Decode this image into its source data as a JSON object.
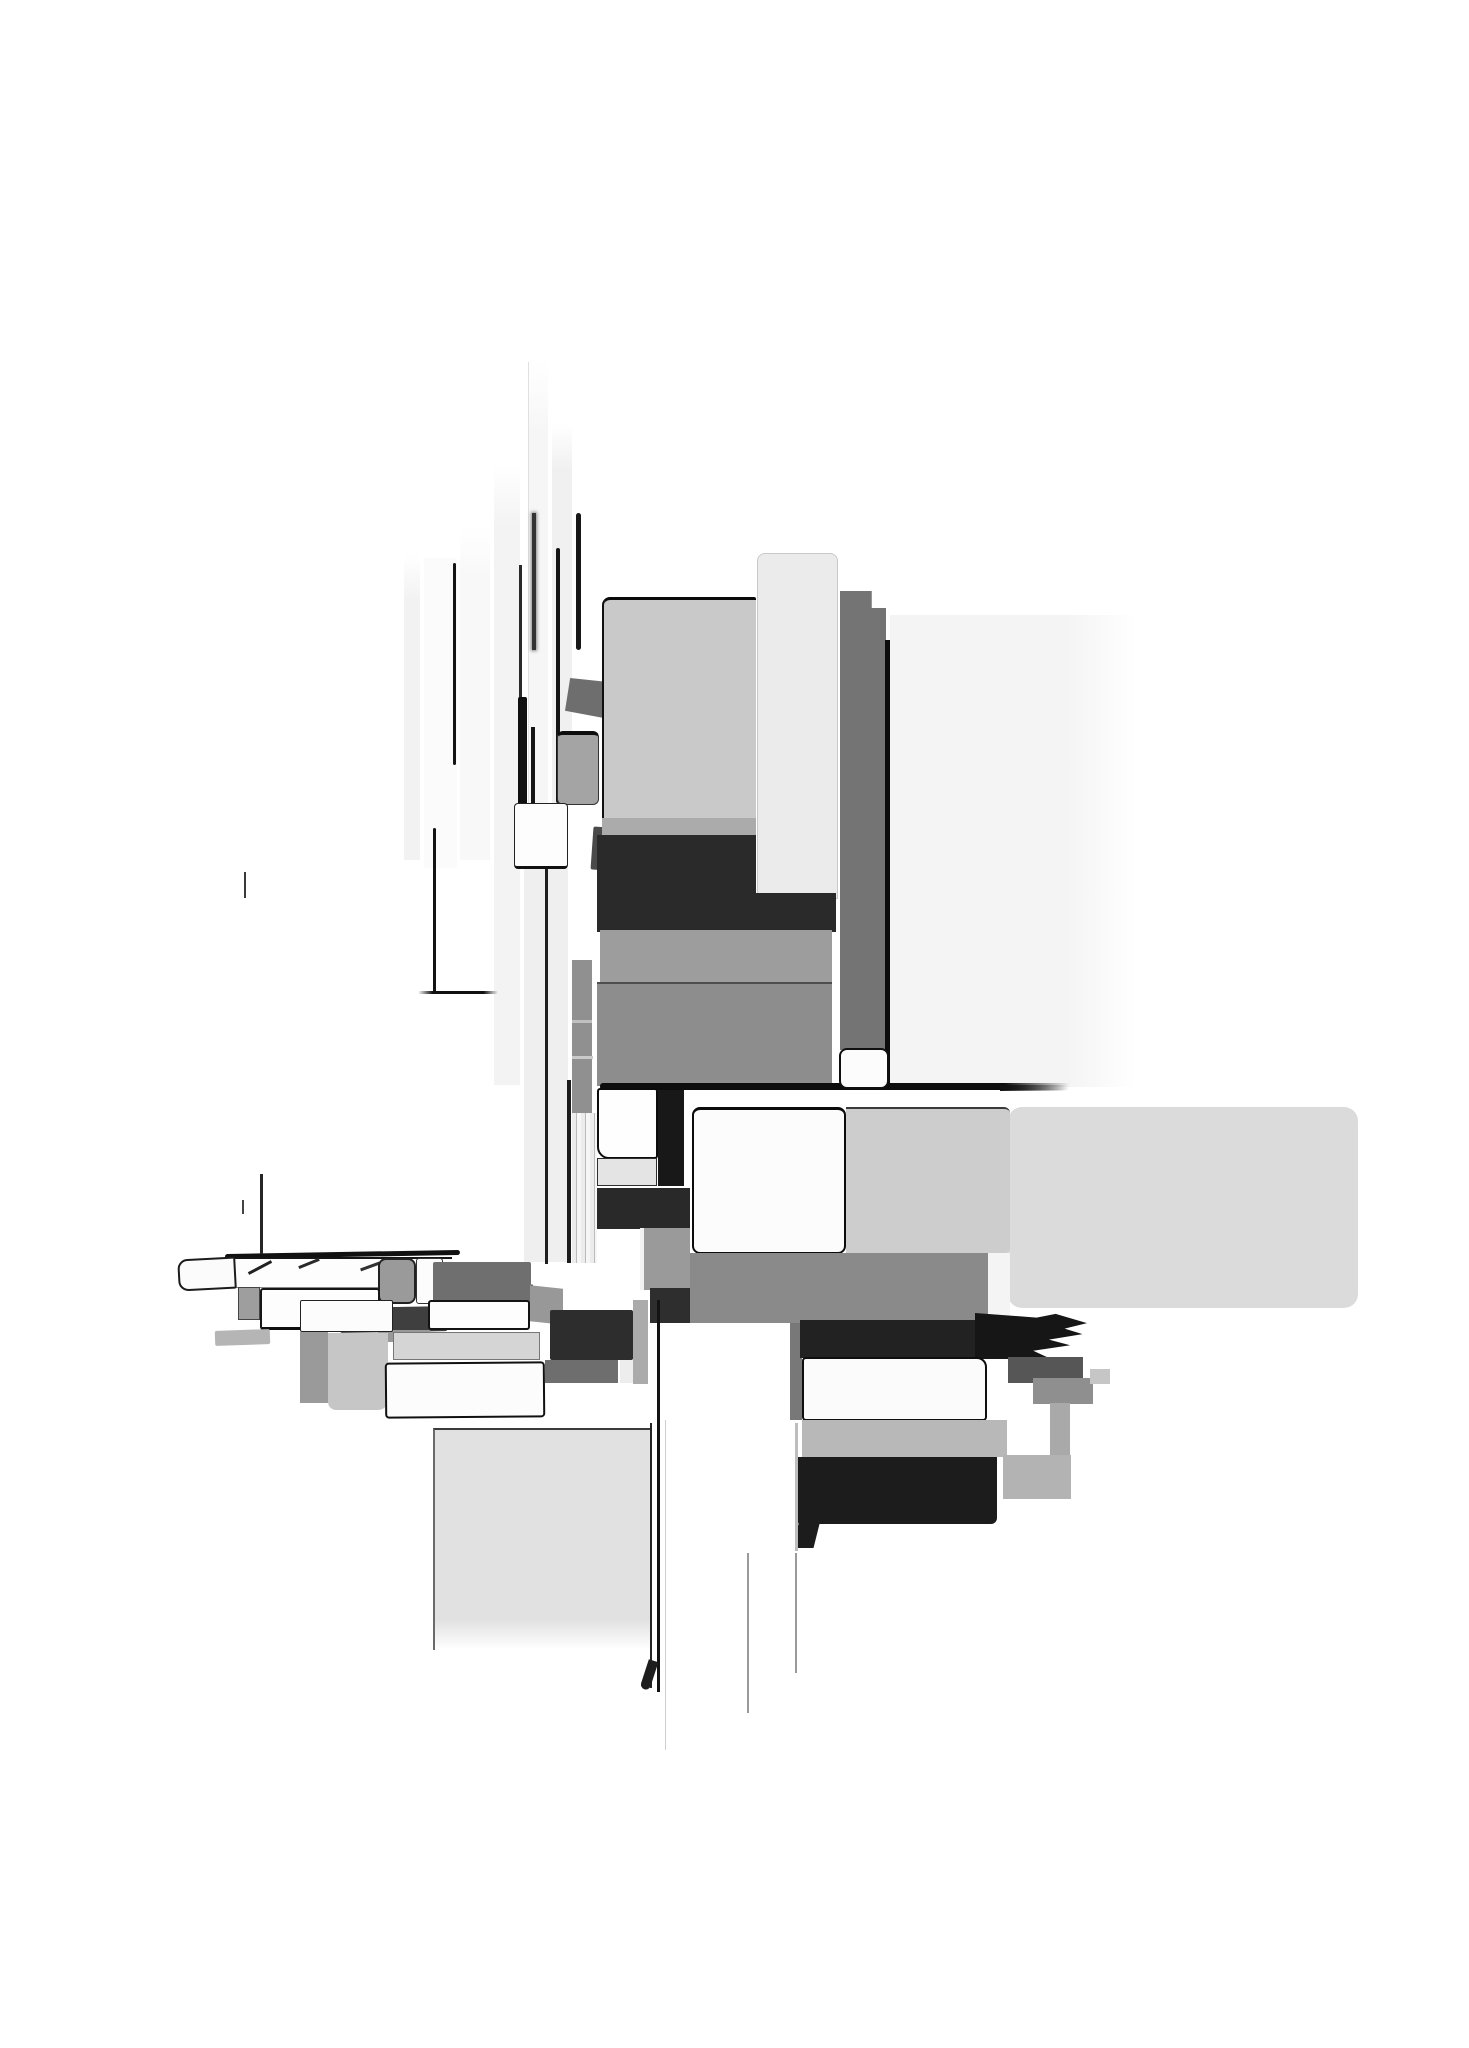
{
  "meta": {
    "title": "abstract-grayscale-block-composition",
    "background_color": "#ffffff",
    "palette": {
      "near_black": "#111111",
      "dark": "#2a2a2a",
      "mid_dark": "#6f6f6f",
      "mid": "#8d8d8d",
      "light_mid": "#9e9e9e",
      "light": "#c9c9c9",
      "pale": "#dcdcdc",
      "faint": "#f4f4f4"
    }
  },
  "shapes": [
    {
      "n": "upper-right-pale-field",
      "x": 890,
      "y": 615,
      "w": 246,
      "h": 472,
      "g": "linear-gradient(90deg,#f4f4f4 0%,#f4f4f4 72%,rgba(255,255,255,0) 100%)"
    },
    {
      "n": "faint-strip-e",
      "x": 404,
      "y": 555,
      "w": 16,
      "h": 305,
      "g": "linear-gradient(180deg,rgba(242,242,242,0),#f2f2f2 15%)"
    },
    {
      "n": "white-strip-d",
      "x": 424,
      "y": 558,
      "w": 33,
      "h": 310,
      "c": "#fbfbfb"
    },
    {
      "n": "faint-strip-c",
      "x": 460,
      "y": 527,
      "w": 30,
      "h": 333,
      "g": "linear-gradient(180deg,rgba(248,248,248,0),#f8f8f8 15%)"
    },
    {
      "n": "faint-strip-b",
      "x": 494,
      "y": 465,
      "w": 26,
      "h": 620,
      "g": "linear-gradient(180deg,rgba(243,243,243,0),#f3f3f3 10%)"
    },
    {
      "n": "tall-pale-column",
      "x": 528,
      "y": 362,
      "w": 20,
      "h": 900,
      "g": "linear-gradient(180deg,rgba(246,246,246,0),#f6f6f6 8%)",
      "bl": "1px solid #e0e0e0"
    },
    {
      "n": "faint-strip-f",
      "x": 552,
      "y": 425,
      "w": 20,
      "h": 378,
      "g": "linear-gradient(180deg,rgba(240,240,240,0),#f0f0f0 12%)"
    },
    {
      "n": "pale-column-lower",
      "x": 524,
      "y": 868,
      "w": 44,
      "h": 394,
      "c": "#efefef"
    },
    {
      "n": "small-gray-column",
      "x": 572,
      "y": 960,
      "w": 20,
      "h": 153,
      "c": "#909090"
    },
    {
      "n": "gray-column-divider-1",
      "x": 572,
      "y": 1020,
      "w": 20,
      "h": 3,
      "c": "#c0c0c0"
    },
    {
      "n": "gray-column-divider-2",
      "x": 572,
      "y": 1056,
      "w": 21,
      "h": 3,
      "c": "#c9c9c9"
    },
    {
      "n": "striped-strip",
      "x": 572,
      "y": 1113,
      "w": 25,
      "h": 150,
      "g": "repeating-linear-gradient(90deg,#ececec 0 4px,#bbbbbb 4px 5px,#f6f6f6 5px 9px)"
    },
    {
      "n": "strip-d-right-edge",
      "x": 453,
      "y": 563,
      "w": 3,
      "h": 202,
      "c": "#161616",
      "r": "2px"
    },
    {
      "n": "thin-line-pair",
      "x": 519,
      "y": 565,
      "w": 3,
      "h": 140,
      "c": "#2a2a2a"
    },
    {
      "n": "thick-black-bar",
      "x": 518,
      "y": 697,
      "w": 9,
      "h": 108,
      "c": "#101010",
      "r": "2px"
    },
    {
      "n": "inner-black-line",
      "x": 531,
      "y": 727,
      "w": 4,
      "h": 76,
      "c": "#151515"
    },
    {
      "n": "blurred-black-line",
      "x": 532,
      "y": 513,
      "w": 4,
      "h": 137,
      "c": "#333333",
      "sh": "0 0 3px 1px rgba(40,40,40,0.55)"
    },
    {
      "n": "strip-f-left-edge",
      "x": 556,
      "y": 548,
      "w": 4,
      "h": 255,
      "c": "#141414",
      "r": "2px"
    },
    {
      "n": "strip-f-right-edge",
      "x": 576,
      "y": 513,
      "w": 5,
      "h": 137,
      "c": "#181818",
      "r": "3px"
    },
    {
      "n": "column-hairline",
      "x": 545,
      "y": 866,
      "w": 3,
      "h": 398,
      "c": "#1f1f1f"
    },
    {
      "n": "column-right-edge",
      "x": 567,
      "y": 1080,
      "w": 4,
      "h": 183,
      "c": "#1c1c1c"
    },
    {
      "n": "skewed-dark-wedge",
      "x": 565,
      "y": 678,
      "w": 43,
      "h": 40,
      "c": "#6e6e6e",
      "cp": "polygon(12% 0,100% 10%,90% 100%,0 82%)"
    },
    {
      "n": "mid-gray-block",
      "x": 557,
      "y": 731,
      "w": 42,
      "h": 74,
      "c": "#a4a4a4",
      "b": "1px solid #333333",
      "bt": "4px solid #0d0d0d",
      "r": "6px"
    },
    {
      "n": "small-white-block",
      "x": 514,
      "y": 803,
      "w": 54,
      "h": 66,
      "c": "#fdfdfd",
      "b": "1px solid #222222",
      "bb": "3px solid #111111",
      "r": "4px"
    },
    {
      "n": "small-dark-wedge",
      "x": 592,
      "y": 827,
      "w": 17,
      "h": 43,
      "c": "#4a4a4a",
      "t": "rotate(4deg)",
      "r": "2px"
    },
    {
      "n": "tower-main-slab",
      "x": 602,
      "y": 597,
      "w": 154,
      "h": 240,
      "c": "#c9c9c9",
      "bt": "3px solid #090909",
      "bl": "2px solid #101010",
      "bb": "3px solid #090909",
      "r": "8px 2px 0 0"
    },
    {
      "n": "tower-bottom-sliver",
      "x": 602,
      "y": 818,
      "w": 154,
      "h": 17,
      "c": "#ababab"
    },
    {
      "n": "tower-pale-slab",
      "x": 757,
      "y": 553,
      "w": 81,
      "h": 346,
      "c": "#ebebeb",
      "b": "1px solid #c9c9c9",
      "r": "8px 8px 0 0"
    },
    {
      "n": "tower-darkgray-strip",
      "x": 840,
      "y": 591,
      "w": 46,
      "h": 459,
      "c": "#747474",
      "cp": "polygon(0 0,69% 0,69% 3.7%,100% 3.7%,100% 100%,0 100%)"
    },
    {
      "n": "tower-black-strip",
      "x": 885,
      "y": 640,
      "w": 5,
      "h": 447,
      "c": "#0c0c0c"
    },
    {
      "n": "central-dark-block",
      "x": 597,
      "y": 835,
      "w": 159,
      "h": 97,
      "c": "#2a2a2a"
    },
    {
      "n": "central-dark-block-ext",
      "x": 754,
      "y": 893,
      "w": 82,
      "h": 39,
      "c": "#2a2a2a"
    },
    {
      "n": "gray-band-upper",
      "x": 600,
      "y": 930,
      "w": 232,
      "h": 53,
      "c": "#9d9d9d"
    },
    {
      "n": "gray-band-lower",
      "x": 597,
      "y": 982,
      "w": 235,
      "h": 104,
      "c": "#8d8d8d",
      "bt": "2px solid #4e4e4e"
    },
    {
      "n": "main-horizontal-line",
      "x": 600,
      "y": 1083,
      "w": 470,
      "h": 7,
      "g": "linear-gradient(90deg,#0d0d0d 0%,#0d0d0d 86%,rgba(13,13,13,0) 100%)",
      "r": "3px"
    },
    {
      "n": "strip-foot-white-block",
      "x": 839,
      "y": 1048,
      "w": 50,
      "h": 41,
      "c": "#fcfcfc",
      "b": "2px solid #101010",
      "r": "8px"
    },
    {
      "n": "center-white-block",
      "x": 597,
      "y": 1088,
      "w": 61,
      "h": 71,
      "c": "#fefefe",
      "b": "2px solid #0c0c0c",
      "r": "3px 3px 3px 12px"
    },
    {
      "n": "center-black-strip",
      "x": 658,
      "y": 1090,
      "w": 26,
      "h": 96,
      "c": "#181818"
    },
    {
      "n": "center-pale-band",
      "x": 597,
      "y": 1158,
      "w": 60,
      "h": 28,
      "c": "#e4e4e4",
      "b": "1px solid #2e2e2e"
    },
    {
      "n": "center-dark-band",
      "x": 597,
      "y": 1188,
      "w": 93,
      "h": 41,
      "c": "#292929"
    },
    {
      "n": "center-gray-piece",
      "x": 640,
      "y": 1228,
      "w": 50,
      "h": 62,
      "c": "#9a9a9a",
      "bl": "4px solid #f2f2f2"
    },
    {
      "n": "center-dark-piece",
      "x": 650,
      "y": 1288,
      "w": 40,
      "h": 35,
      "c": "#2e2e2e"
    },
    {
      "n": "center-white-sliver",
      "x": 620,
      "y": 1318,
      "w": 13,
      "h": 65,
      "c": "#ededed"
    },
    {
      "n": "center-gray-sliver",
      "x": 633,
      "y": 1300,
      "w": 15,
      "h": 84,
      "c": "#ababab"
    },
    {
      "n": "right-arm-pale-slab",
      "x": 1008,
      "y": 1107,
      "w": 350,
      "h": 201,
      "c": "#dbdbdb",
      "r": "14px"
    },
    {
      "n": "right-arm-gray-slab",
      "x": 846,
      "y": 1107,
      "w": 164,
      "h": 147,
      "c": "#cdcdcd",
      "bt": "2px solid #3a3a3a",
      "r": "0 6px 6px 0"
    },
    {
      "n": "right-arm-white-slab",
      "x": 692,
      "y": 1107,
      "w": 154,
      "h": 147,
      "c": "#fcfcfc",
      "b": "2px solid #0b0b0b",
      "bt": "3px solid #0b0b0b",
      "r": "8px"
    },
    {
      "n": "fading-line-right",
      "x": 1000,
      "y": 1085,
      "w": 67,
      "h": 6,
      "g": "linear-gradient(90deg,#111111,rgba(17,17,17,0))"
    },
    {
      "n": "arm-mid-gray-band",
      "x": 690,
      "y": 1253,
      "w": 298,
      "h": 70,
      "c": "#8a8a8a"
    },
    {
      "n": "arm-white-strip",
      "x": 988,
      "y": 1253,
      "w": 22,
      "h": 70,
      "c": "#f4f4f4"
    },
    {
      "n": "arm-left-gray-strip",
      "x": 790,
      "y": 1323,
      "w": 12,
      "h": 97,
      "c": "#787878"
    },
    {
      "n": "arm-black-band",
      "x": 800,
      "y": 1320,
      "w": 178,
      "h": 38,
      "c": "#222222"
    },
    {
      "n": "arm-black-spiky",
      "x": 975,
      "y": 1313,
      "w": 112,
      "h": 46,
      "c": "#161616",
      "cp": "polygon(0 0,55% 10%,72% 2%,100% 22%,80% 34%,96% 46%,66% 58%,85% 70%,52% 82%,68% 100%,0 100%)"
    },
    {
      "n": "arm-darkgray-block",
      "x": 1008,
      "y": 1357,
      "w": 75,
      "h": 26,
      "c": "#565656"
    },
    {
      "n": "arm-gray-block",
      "x": 1033,
      "y": 1378,
      "w": 60,
      "h": 26,
      "c": "#8f8f8f"
    },
    {
      "n": "arm-light-piece",
      "x": 1090,
      "y": 1369,
      "w": 20,
      "h": 15,
      "c": "#c6c6c6"
    },
    {
      "n": "arm-white-band",
      "x": 802,
      "y": 1357,
      "w": 185,
      "h": 64,
      "c": "#fbfbfb",
      "b": "2px solid #0e0e0e",
      "r": "4px 10px 4px 4px"
    },
    {
      "n": "arm-lightgray-band",
      "x": 802,
      "y": 1420,
      "w": 205,
      "h": 37,
      "c": "#b8b8b8"
    },
    {
      "n": "bottom-black-block",
      "x": 798,
      "y": 1457,
      "w": 199,
      "h": 67,
      "c": "#1c1c1c",
      "r": "0 0 6px 2px"
    },
    {
      "n": "bottom-black-foot",
      "x": 796,
      "y": 1520,
      "w": 21,
      "h": 28,
      "c": "#1c1c1c",
      "t": "skewX(-14deg)"
    },
    {
      "n": "bottom-gray-strip",
      "x": 1050,
      "y": 1403,
      "w": 20,
      "h": 53,
      "c": "#a9a9a9"
    },
    {
      "n": "bottom-gray-patch",
      "x": 1003,
      "y": 1455,
      "w": 68,
      "h": 44,
      "c": "#b3b3b3"
    },
    {
      "n": "bottom-white-column",
      "x": 665,
      "y": 1420,
      "w": 133,
      "h": 330,
      "c": "#ffffff",
      "bl": "1px solid #cfcfcf"
    },
    {
      "n": "double-line-a",
      "x": 650,
      "y": 1423,
      "w": 2,
      "h": 265,
      "c": "#242424"
    },
    {
      "n": "double-line-b",
      "x": 657,
      "y": 1300,
      "w": 3,
      "h": 392,
      "c": "#131313"
    },
    {
      "n": "line-foot-curl",
      "x": 644,
      "y": 1660,
      "w": 10,
      "h": 30,
      "c": "#1d1d1d",
      "t": "rotate(18deg)",
      "r": "0 0 6px 6px"
    },
    {
      "n": "bottom-pale-slab",
      "x": 433,
      "y": 1428,
      "w": 217,
      "h": 222,
      "g": "linear-gradient(180deg,#e1e1e1 0%,#e1e1e1 86%,rgba(225,225,225,0) 100%)",
      "bl": "2px solid #6a6a6a",
      "bt": "2px solid #3a3a3a"
    },
    {
      "n": "thin-line-bottom-1",
      "x": 747,
      "y": 1553,
      "w": 2,
      "h": 160,
      "c": "#9a9a9a"
    },
    {
      "n": "thin-line-bottom-2",
      "x": 795,
      "y": 1553,
      "w": 2,
      "h": 120,
      "c": "#9a9a9a"
    },
    {
      "n": "column-right-hairline",
      "x": 795,
      "y": 1423,
      "w": 3,
      "h": 128,
      "c": "#bdbdbd"
    },
    {
      "n": "leftarm-top-line",
      "x": 225,
      "y": 1252,
      "w": 235,
      "h": 5,
      "c": "#111111",
      "r": "3px",
      "t": "rotate(-1deg)"
    },
    {
      "n": "leftarm-white-band",
      "x": 235,
      "y": 1257,
      "w": 217,
      "h": 31,
      "c": "#fdfdfd",
      "bt": "2px solid #151515",
      "bb": "1px solid #888888"
    },
    {
      "n": "leftarm-tip",
      "x": 178,
      "y": 1258,
      "w": 58,
      "h": 32,
      "c": "#fbfbfb",
      "b": "2px solid #1c1c1c",
      "r": "10px 2px 2px 10px",
      "t": "rotate(-3deg)"
    },
    {
      "n": "hatch-mark-1",
      "x": 247,
      "y": 1266,
      "w": 26,
      "h": 3,
      "c": "#222222",
      "t": "rotate(-28deg)"
    },
    {
      "n": "hatch-mark-2",
      "x": 298,
      "y": 1262,
      "w": 22,
      "h": 3,
      "c": "#2a2a2a",
      "t": "rotate(-22deg)"
    },
    {
      "n": "hatch-mark-3",
      "x": 360,
      "y": 1265,
      "w": 20,
      "h": 3,
      "c": "#333333",
      "t": "rotate(-20deg)"
    },
    {
      "n": "hatch-mark-4",
      "x": 445,
      "y": 1268,
      "w": 18,
      "h": 3,
      "c": "#222222",
      "t": "rotate(-26deg)"
    },
    {
      "n": "hatch-mark-5",
      "x": 518,
      "y": 1288,
      "w": 16,
      "h": 3,
      "c": "#222222",
      "t": "rotate(-30deg)"
    },
    {
      "n": "hatch-mark-6",
      "x": 332,
      "y": 1303,
      "w": 18,
      "h": 3,
      "c": "#1c1c1c",
      "t": "rotate(-35deg)"
    },
    {
      "n": "hatch-mark-7",
      "x": 483,
      "y": 1278,
      "w": 14,
      "h": 3,
      "c": "#333333",
      "t": "rotate(-24deg)"
    },
    {
      "n": "leftarm-gray-round",
      "x": 378,
      "y": 1258,
      "w": 38,
      "h": 46,
      "c": "#9a9a9a",
      "b": "2px solid #222222",
      "r": "8px"
    },
    {
      "n": "leftarm-white-small",
      "x": 416,
      "y": 1258,
      "w": 27,
      "h": 46,
      "c": "#fcfcfc",
      "b": "1px solid #333333",
      "r": "3px"
    },
    {
      "n": "leftarm-darkgray-band",
      "x": 433,
      "y": 1262,
      "w": 98,
      "h": 41,
      "c": "#6f6f6f",
      "r": "2px"
    },
    {
      "n": "leftarm-gray-left",
      "x": 238,
      "y": 1287,
      "w": 22,
      "h": 33,
      "c": "#9e9e9e",
      "b": "1px solid #444444"
    },
    {
      "n": "leftarm-white-mid",
      "x": 260,
      "y": 1288,
      "w": 120,
      "h": 42,
      "c": "#fdfdfd",
      "b": "2px solid #161616",
      "bb": "3px solid #101010",
      "r": "3px"
    },
    {
      "n": "leftarm-dark-under",
      "x": 340,
      "y": 1307,
      "w": 107,
      "h": 25,
      "c": "#3f3f3f",
      "r": "2px",
      "t": "rotate(-1deg)"
    },
    {
      "n": "leftarm-gray-under",
      "x": 378,
      "y": 1330,
      "w": 52,
      "h": 12,
      "c": "#999999"
    },
    {
      "n": "leftarm-gray-tip2",
      "x": 215,
      "y": 1330,
      "w": 55,
      "h": 15,
      "c": "#b5b5b5",
      "t": "rotate(-2deg)",
      "r": "2px"
    },
    {
      "n": "leftarm-white-band2",
      "x": 300,
      "y": 1300,
      "w": 93,
      "h": 32,
      "c": "#fcfcfc",
      "b": "1px solid #222222",
      "r": "2px"
    },
    {
      "n": "leftarm-gray-column",
      "x": 300,
      "y": 1332,
      "w": 28,
      "h": 71,
      "c": "#9a9a9a"
    },
    {
      "n": "leftarm-light-column",
      "x": 328,
      "y": 1333,
      "w": 60,
      "h": 77,
      "c": "#c6c6c6",
      "r": "0 0 10px 8px"
    },
    {
      "n": "leftarm-white-band3",
      "x": 428,
      "y": 1300,
      "w": 102,
      "h": 30,
      "c": "#fdfdfd",
      "b": "2px solid #131313",
      "r": "3px"
    },
    {
      "n": "leftarm-gray-wedge",
      "x": 530,
      "y": 1287,
      "w": 33,
      "h": 36,
      "c": "#989898",
      "t": "skewY(6deg)"
    },
    {
      "n": "leftarm-light-band",
      "x": 393,
      "y": 1332,
      "w": 147,
      "h": 28,
      "c": "#d5d5d5",
      "b": "1px solid #777777"
    },
    {
      "n": "leftarm-white-band4",
      "x": 385,
      "y": 1362,
      "w": 160,
      "h": 56,
      "c": "#fcfcfc",
      "b": "2px solid #101010",
      "r": "4px",
      "t": "rotate(-0.5deg)"
    },
    {
      "n": "leftarm-dark-block",
      "x": 550,
      "y": 1310,
      "w": 83,
      "h": 50,
      "c": "#2d2d2d",
      "r": "2px"
    },
    {
      "n": "leftarm-gray-band2",
      "x": 545,
      "y": 1360,
      "w": 73,
      "h": 23,
      "c": "#6e6e6e"
    },
    {
      "n": "l-hairline-vertical",
      "x": 433,
      "y": 828,
      "w": 3,
      "h": 166,
      "c": "#131313",
      "r": "2px"
    },
    {
      "n": "l-hairline-horizontal",
      "x": 418,
      "y": 991,
      "w": 80,
      "h": 3,
      "g": "linear-gradient(90deg,rgba(17,17,17,0),#111111 18%,#111111 82%,rgba(17,17,17,0))"
    },
    {
      "n": "hairline-short-a",
      "x": 244,
      "y": 872,
      "w": 2,
      "h": 26,
      "c": "#3a3a3a"
    },
    {
      "n": "hairline-short-b",
      "x": 260,
      "y": 1174,
      "w": 3,
      "h": 80,
      "c": "#262626"
    },
    {
      "n": "hairline-short-c",
      "x": 242,
      "y": 1200,
      "w": 2,
      "h": 14,
      "c": "#444444"
    }
  ]
}
